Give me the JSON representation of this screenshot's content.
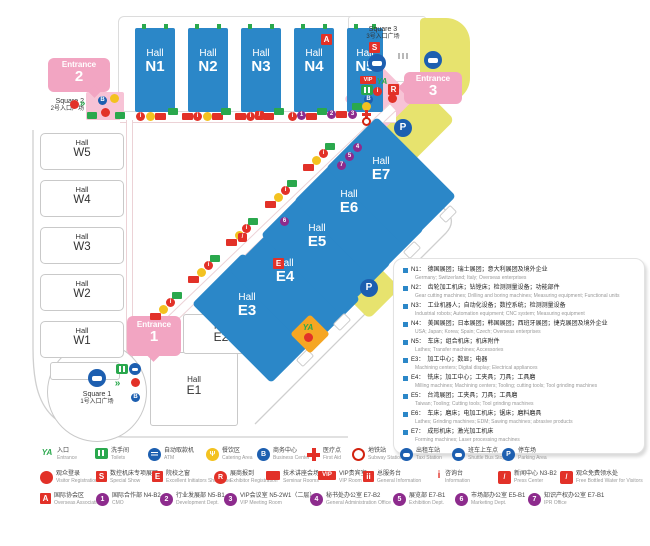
{
  "halls": {
    "word": "Hall",
    "n": [
      "N1",
      "N2",
      "N3",
      "N4",
      "N5"
    ],
    "w": [
      "W5",
      "W4",
      "W3",
      "W2",
      "W1"
    ],
    "e_white": [
      "E1",
      "E2"
    ],
    "e": [
      "E3",
      "E4",
      "E5",
      "E6",
      "E7"
    ]
  },
  "entrances": [
    {
      "word": "Entrance",
      "num": "1"
    },
    {
      "word": "Entrance",
      "num": "2"
    },
    {
      "word": "Entrance",
      "num": "3"
    }
  ],
  "squares": [
    {
      "en": "Square 1",
      "zh": "1号入口广场"
    },
    {
      "en": "Square 2",
      "zh": "2号入口广场"
    },
    {
      "en": "Square 3",
      "zh": "3号入口广场"
    }
  ],
  "icons": {
    "info": "i",
    "info_double": "ii",
    "business": "B",
    "parking": "P",
    "special_show": "S",
    "showcase": "E",
    "exhibitor_reg": "R",
    "assoc": "A",
    "vip": "VIP",
    "entrance_ya": "YA",
    "slash": "/",
    "catering": "Ψ",
    "arrows": "»",
    "nums": [
      "1",
      "2",
      "3",
      "4",
      "5",
      "6",
      "7"
    ]
  },
  "colors": {
    "hall_blue": "#2b87c8",
    "entrance_pink": "#f2a5c2",
    "area_yellow": "#e7e36e",
    "icon_red": "#e23128",
    "icon_green": "#2aa84d",
    "icon_blue": "#1d5fb0",
    "icon_purple": "#8d2b8d",
    "icon_yellow": "#f3c220"
  },
  "hall_legend": {
    "items": [
      {
        "id": "N1：",
        "zh": "德国展团；瑞士展团；意大利展团及境外企业",
        "en": "Germany; Switzerland; Italy; Overseas enterprises"
      },
      {
        "id": "N2：",
        "zh": "齿轮加工机床；钻镗床；检测测量设备；功能部件",
        "en": "Gear cutting machines; Drilling and boring machines; Measuring equipment; Functional units"
      },
      {
        "id": "N3：",
        "zh": "工业机器人；自动化设备；数控系统；检测测量设备",
        "en": "Industrial robots; Automation equipment; CNC system; Measuring equipment"
      },
      {
        "id": "N4：",
        "zh": "美国展团；日本展团；韩国展团；西班牙展团；捷克展团及境外企业",
        "en": "USA; Japan; Korea; Spain; Czech; Overseas enterprises"
      },
      {
        "id": "N5：",
        "zh": "车床；组合机床；机床附件",
        "en": "Lathes; Transfer machines; Accessories"
      },
      {
        "id": "E3：",
        "zh": "加工中心；数显；电器",
        "en": "Machining centers; Digital display; Electrical appliances"
      },
      {
        "id": "E4：",
        "zh": "铣床；加工中心；工夹具；刀具；工具磨",
        "en": "Milling machines; Machining centers; Tooling; cutting tools; Tool grinding machines"
      },
      {
        "id": "E5：",
        "zh": "台湾展团；工夹具；刀具；工具磨",
        "en": "Taiwan; Tooling; Cutting tools; Tool grinding machines"
      },
      {
        "id": "E6：",
        "zh": "车床；磨床；电加工机床；锯床；磨料磨具",
        "en": "Lathes; Grinding machines; EDM; Sawing machines; abrasive products"
      },
      {
        "id": "E7：",
        "zh": "成形机床；激光加工机床",
        "en": "Forming machines; Laser processing machines"
      }
    ]
  },
  "facility_legend": {
    "rows": [
      [
        {
          "zh": "入口",
          "en": "Entrance"
        },
        {
          "zh": "洗手间",
          "en": "Toilets"
        },
        {
          "zh": "自动取款机",
          "en": "ATM"
        },
        {
          "zh": "餐饮区",
          "en": "Catering Area"
        },
        {
          "zh": "商务中心",
          "en": "Business Center"
        },
        {
          "zh": "医疗点",
          "en": "First Aid"
        },
        {
          "zh": "地铁站",
          "en": "Subway Station"
        },
        {
          "zh": "出租车站",
          "en": "Taxi Station"
        },
        {
          "zh": "班车上车点",
          "en": "Shuttle Bus Stop"
        },
        {
          "zh": "停车场",
          "en": "Parking Area"
        }
      ],
      [
        {
          "zh": "观众登录",
          "en": "Visitor Registration"
        },
        {
          "zh": "数控机床专项展区",
          "en": "Special Show"
        },
        {
          "zh": "院校之窗",
          "en": "Excellent Initiators Showcase"
        },
        {
          "zh": "展商报到",
          "en": "Exhibitor Registration"
        },
        {
          "zh": "技术讲座会场",
          "en": "Seminar Rooms"
        },
        {
          "zh": "VIP贵宾室",
          "en": "VIP Room"
        },
        {
          "zh": "总服务台",
          "en": "General Information"
        },
        {
          "zh": "咨询台",
          "en": "Information"
        },
        {
          "zh": "新闻中心 N3-B2",
          "en": "Press Center"
        },
        {
          "zh": "观众免费领水处",
          "en": "Free Bottled Water for Visitors"
        }
      ],
      [
        {
          "zh": "国际协会区",
          "en": "Overseas Associations"
        },
        {
          "zh": "国际合作部 N4-B2",
          "en": "CMO"
        },
        {
          "zh": "行业发展部 N5-B1",
          "en": "Development Dept."
        },
        {
          "zh": "VIP会议室 N5-2W1（二层）",
          "en": "VIP Meeting Room"
        },
        {
          "zh": "秘书处办公室 E7-B2",
          "en": "General Administration Office"
        },
        {
          "zh": "展览部 E7-B1",
          "en": "Exhibition Dept."
        },
        {
          "zh": "市场部办公室 E5-B1",
          "en": "Marketing Dept."
        },
        {
          "zh": "知识产权办公室 E7-B1",
          "en": "IPR Office"
        }
      ]
    ]
  }
}
